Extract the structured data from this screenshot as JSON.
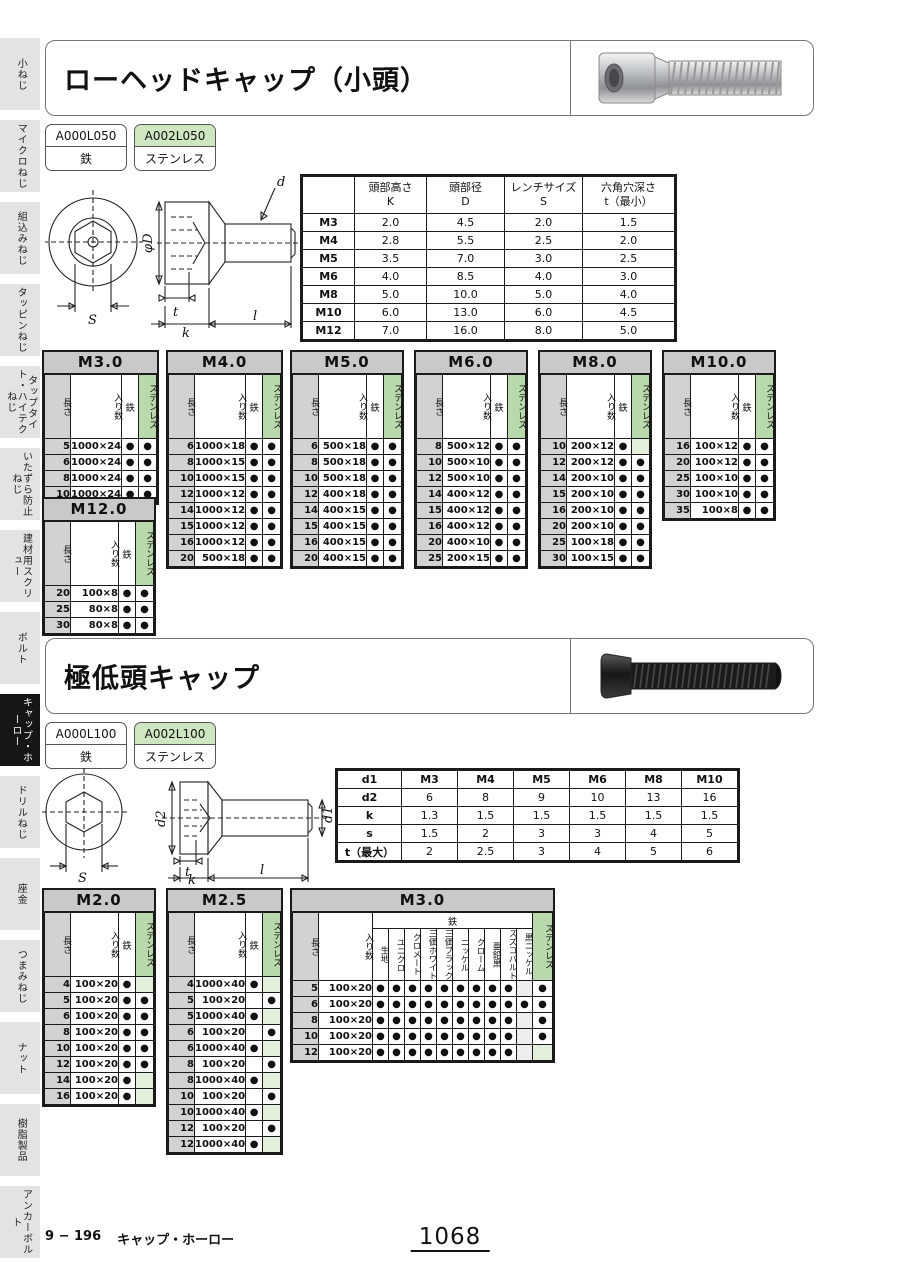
{
  "sidebar": {
    "active_index": 8,
    "items": [
      "小ねじ",
      "マイクロねじ",
      "組込みねじ",
      "タッピンねじ",
      "タップタイト・ハイテクねじ",
      "いたずら防止ねじ",
      "建材用スクリュー",
      "ボルト",
      "キャップ・ホーロー",
      "ドリルねじ",
      "座金",
      "つまみねじ",
      "ナット",
      "樹脂製品",
      "アンカーボルト"
    ]
  },
  "size_table_headers": {
    "length": "長さ",
    "qty": "入り数",
    "iron": "鉄",
    "stainless": "ステンレス"
  },
  "sections": [
    {
      "title": "ローヘッドキャップ（小頭）",
      "photo_name": "low-head-cap-screw-silver",
      "codes": [
        {
          "code": "A000L050",
          "material": "鉄",
          "variant": "iron"
        },
        {
          "code": "A002L050",
          "material": "ステンレス",
          "variant": "stainless"
        }
      ],
      "drawing_labels": {
        "s": "S",
        "phiD": "φD",
        "d": "d",
        "t": "t",
        "k": "k",
        "l": "l"
      },
      "dim_table": {
        "col_widths": [
          52,
          72,
          78,
          78,
          92
        ],
        "headers": [
          "",
          [
            "頭部高さ",
            "K"
          ],
          [
            "頭部径",
            "D"
          ],
          [
            "レンチサイズ",
            "S"
          ],
          [
            "六角穴深さ",
            "t（最小）"
          ]
        ],
        "rows": [
          [
            "M3",
            "2.0",
            "4.5",
            "2.0",
            "1.5"
          ],
          [
            "M4",
            "2.8",
            "5.5",
            "2.5",
            "2.0"
          ],
          [
            "M5",
            "3.5",
            "7.0",
            "3.0",
            "2.5"
          ],
          [
            "M6",
            "4.0",
            "8.5",
            "4.0",
            "3.0"
          ],
          [
            "M8",
            "5.0",
            "10.0",
            "5.0",
            "4.0"
          ],
          [
            "M10",
            "6.0",
            "13.0",
            "6.0",
            "4.5"
          ],
          [
            "M12",
            "7.0",
            "16.0",
            "8.0",
            "5.0"
          ]
        ]
      },
      "size_tables": [
        {
          "title": "M3.0",
          "rows": [
            [
              "5",
              "1000×24",
              1,
              1
            ],
            [
              "6",
              "1000×24",
              1,
              1
            ],
            [
              "8",
              "1000×24",
              1,
              1
            ],
            [
              "10",
              "1000×24",
              1,
              1
            ]
          ]
        },
        {
          "title": "M4.0",
          "rows": [
            [
              "6",
              "1000×18",
              1,
              1
            ],
            [
              "8",
              "1000×15",
              1,
              1
            ],
            [
              "10",
              "1000×15",
              1,
              1
            ],
            [
              "12",
              "1000×12",
              1,
              1
            ],
            [
              "14",
              "1000×12",
              1,
              1
            ],
            [
              "15",
              "1000×12",
              1,
              1
            ],
            [
              "16",
              "1000×12",
              1,
              1
            ],
            [
              "20",
              "500×18",
              1,
              1
            ]
          ]
        },
        {
          "title": "M5.0",
          "rows": [
            [
              "6",
              "500×18",
              1,
              1
            ],
            [
              "8",
              "500×18",
              1,
              1
            ],
            [
              "10",
              "500×18",
              1,
              1
            ],
            [
              "12",
              "400×18",
              1,
              1
            ],
            [
              "14",
              "400×15",
              1,
              1
            ],
            [
              "15",
              "400×15",
              1,
              1
            ],
            [
              "16",
              "400×15",
              1,
              1
            ],
            [
              "20",
              "400×15",
              1,
              1
            ]
          ]
        },
        {
          "title": "M6.0",
          "rows": [
            [
              "8",
              "500×12",
              1,
              1
            ],
            [
              "10",
              "500×10",
              1,
              1
            ],
            [
              "12",
              "500×10",
              1,
              1
            ],
            [
              "14",
              "400×12",
              1,
              1
            ],
            [
              "15",
              "400×12",
              1,
              1
            ],
            [
              "16",
              "400×12",
              1,
              1
            ],
            [
              "20",
              "400×10",
              1,
              1
            ],
            [
              "25",
              "200×15",
              1,
              1
            ]
          ]
        },
        {
          "title": "M8.0",
          "rows": [
            [
              "10",
              "200×12",
              1,
              0
            ],
            [
              "12",
              "200×12",
              1,
              1
            ],
            [
              "14",
              "200×10",
              1,
              1
            ],
            [
              "15",
              "200×10",
              1,
              1
            ],
            [
              "16",
              "200×10",
              1,
              1
            ],
            [
              "20",
              "200×10",
              1,
              1
            ],
            [
              "25",
              "100×18",
              1,
              1
            ],
            [
              "30",
              "100×15",
              1,
              1
            ]
          ]
        },
        {
          "title": "M10.0",
          "rows": [
            [
              "16",
              "100×12",
              1,
              1
            ],
            [
              "20",
              "100×12",
              1,
              1
            ],
            [
              "25",
              "100×10",
              1,
              1
            ],
            [
              "30",
              "100×10",
              1,
              1
            ],
            [
              "35",
              "100×8",
              1,
              1
            ]
          ]
        },
        {
          "title": "M12.0",
          "rows": [
            [
              "20",
              "100×8",
              1,
              1
            ],
            [
              "25",
              "80×8",
              1,
              1
            ],
            [
              "30",
              "80×8",
              1,
              1
            ]
          ]
        }
      ]
    },
    {
      "title": "極低頭キャップ",
      "photo_name": "ultra-low-head-cap-screw-black",
      "codes": [
        {
          "code": "A000L100",
          "material": "鉄",
          "variant": "iron"
        },
        {
          "code": "A002L100",
          "material": "ステンレス",
          "variant": "stainless"
        }
      ],
      "drawing_labels": {
        "s": "S",
        "d1": "d1",
        "d2": "d2",
        "t": "t",
        "k": "k",
        "l": "l"
      },
      "dim_table": {
        "col_widths": [
          64,
          56,
          56,
          56,
          56,
          56,
          56
        ],
        "bold_first_row": true,
        "rows": [
          [
            "d1",
            "M3",
            "M4",
            "M5",
            "M6",
            "M8",
            "M10"
          ],
          [
            "d2",
            "6",
            "8",
            "9",
            "10",
            "13",
            "16"
          ],
          [
            "k",
            "1.3",
            "1.5",
            "1.5",
            "1.5",
            "1.5",
            "1.5"
          ],
          [
            "s",
            "1.5",
            "2",
            "3",
            "3",
            "4",
            "5"
          ],
          [
            "t（最大）",
            "2",
            "2.5",
            "3",
            "4",
            "5",
            "6"
          ]
        ]
      },
      "size_tables": [
        {
          "title": "M2.0",
          "rows": [
            [
              "4",
              "100×20",
              1,
              0
            ],
            [
              "5",
              "100×20",
              1,
              1
            ],
            [
              "6",
              "100×20",
              1,
              1
            ],
            [
              "8",
              "100×20",
              1,
              1
            ],
            [
              "10",
              "100×20",
              1,
              1
            ],
            [
              "12",
              "100×20",
              1,
              1
            ],
            [
              "14",
              "100×20",
              1,
              0
            ],
            [
              "16",
              "100×20",
              1,
              0
            ]
          ]
        },
        {
          "title": "M2.5",
          "rows": [
            [
              "4",
              "1000×40",
              1,
              0
            ],
            [
              "5",
              "100×20",
              0,
              1
            ],
            [
              "5",
              "1000×40",
              1,
              0
            ],
            [
              "6",
              "100×20",
              0,
              1
            ],
            [
              "6",
              "1000×40",
              1,
              0
            ],
            [
              "8",
              "100×20",
              0,
              1
            ],
            [
              "8",
              "1000×40",
              1,
              0
            ],
            [
              "10",
              "100×20",
              0,
              1
            ],
            [
              "10",
              "1000×40",
              1,
              0
            ],
            [
              "12",
              "100×20",
              0,
              1
            ],
            [
              "12",
              "1000×40",
              1,
              0
            ]
          ]
        },
        {
          "title": "M3.0",
          "iron_subcols": [
            "生地",
            "ユニクロ",
            "クロメート",
            "三価ホワイト",
            "三価ブラック",
            "ニッケル",
            "クローム",
            "亜鉛黒",
            "スズコバルト",
            "黒ニッケル"
          ],
          "rows": [
            [
              "5",
              "100×20",
              [
                1,
                1,
                1,
                1,
                1,
                1,
                1,
                1,
                1,
                0
              ],
              1
            ],
            [
              "6",
              "100×20",
              [
                1,
                1,
                1,
                1,
                1,
                1,
                1,
                1,
                1,
                1
              ],
              1
            ],
            [
              "8",
              "100×20",
              [
                1,
                1,
                1,
                1,
                1,
                1,
                1,
                1,
                1,
                0
              ],
              1
            ],
            [
              "10",
              "100×20",
              [
                1,
                1,
                1,
                1,
                1,
                1,
                1,
                1,
                1,
                0
              ],
              1
            ],
            [
              "12",
              "100×20",
              [
                1,
                1,
                1,
                1,
                1,
                1,
                1,
                1,
                1,
                0
              ],
              0
            ]
          ]
        }
      ]
    }
  ],
  "footer": {
    "left": "9 − 196",
    "category": "キャップ・ホーロー",
    "page_number": "1068"
  }
}
